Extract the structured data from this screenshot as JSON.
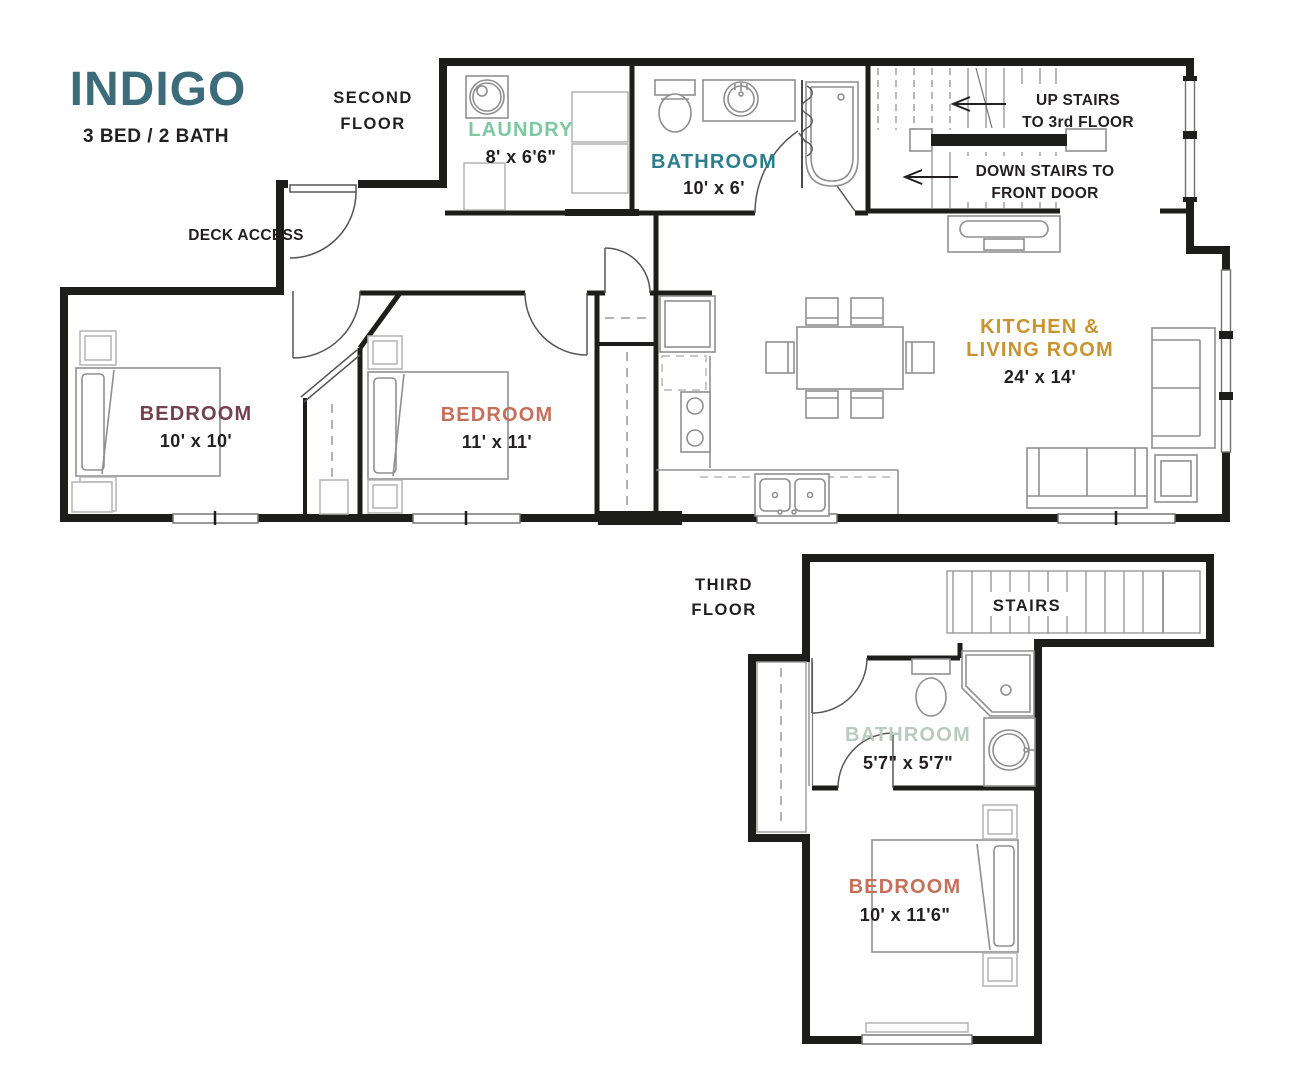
{
  "title": "INDIGO",
  "subtitle": "3 BED / 2 BATH",
  "colors": {
    "title": "#3C6B7A",
    "ink": "#231F20",
    "laundry": "#7DC8A2",
    "bathroom_2f": "#2B7F8C",
    "bedroom_primary": "#74414F",
    "bedroom_accent": "#C4705A",
    "kitchen": "#C79430",
    "bathroom_3f": "#B9CABE",
    "wall": "#1D1D1B",
    "furniture": "#8F8F8F"
  },
  "second_floor": {
    "floor_label_line1": "SECOND",
    "floor_label_line2": "FLOOR",
    "deck_access_label": "DECK ACCESS",
    "laundry": {
      "name": "LAUNDRY",
      "dims": "8' x 6'6\""
    },
    "bathroom": {
      "name": "BATHROOM",
      "dims": "10' x 6'"
    },
    "bedroom_left": {
      "name": "BEDROOM",
      "dims": "10' x 10'"
    },
    "bedroom_middle": {
      "name": "BEDROOM",
      "dims": "11' x 11'"
    },
    "kitchen_living": {
      "name_line1": "KITCHEN &",
      "name_line2": "LIVING ROOM",
      "dims": "24' x 14'"
    },
    "up_stairs": {
      "line1": "UP STAIRS",
      "line2": "TO 3rd FLOOR"
    },
    "down_stairs": {
      "line1": "DOWN STAIRS TO",
      "line2": "FRONT DOOR"
    }
  },
  "third_floor": {
    "floor_label_line1": "THIRD",
    "floor_label_line2": "FLOOR",
    "stairs_label": "STAIRS",
    "bathroom": {
      "name": "BATHROOM",
      "dims": "5'7\" x 5'7\""
    },
    "bedroom": {
      "name": "BEDROOM",
      "dims": "10' x 11'6\""
    }
  }
}
